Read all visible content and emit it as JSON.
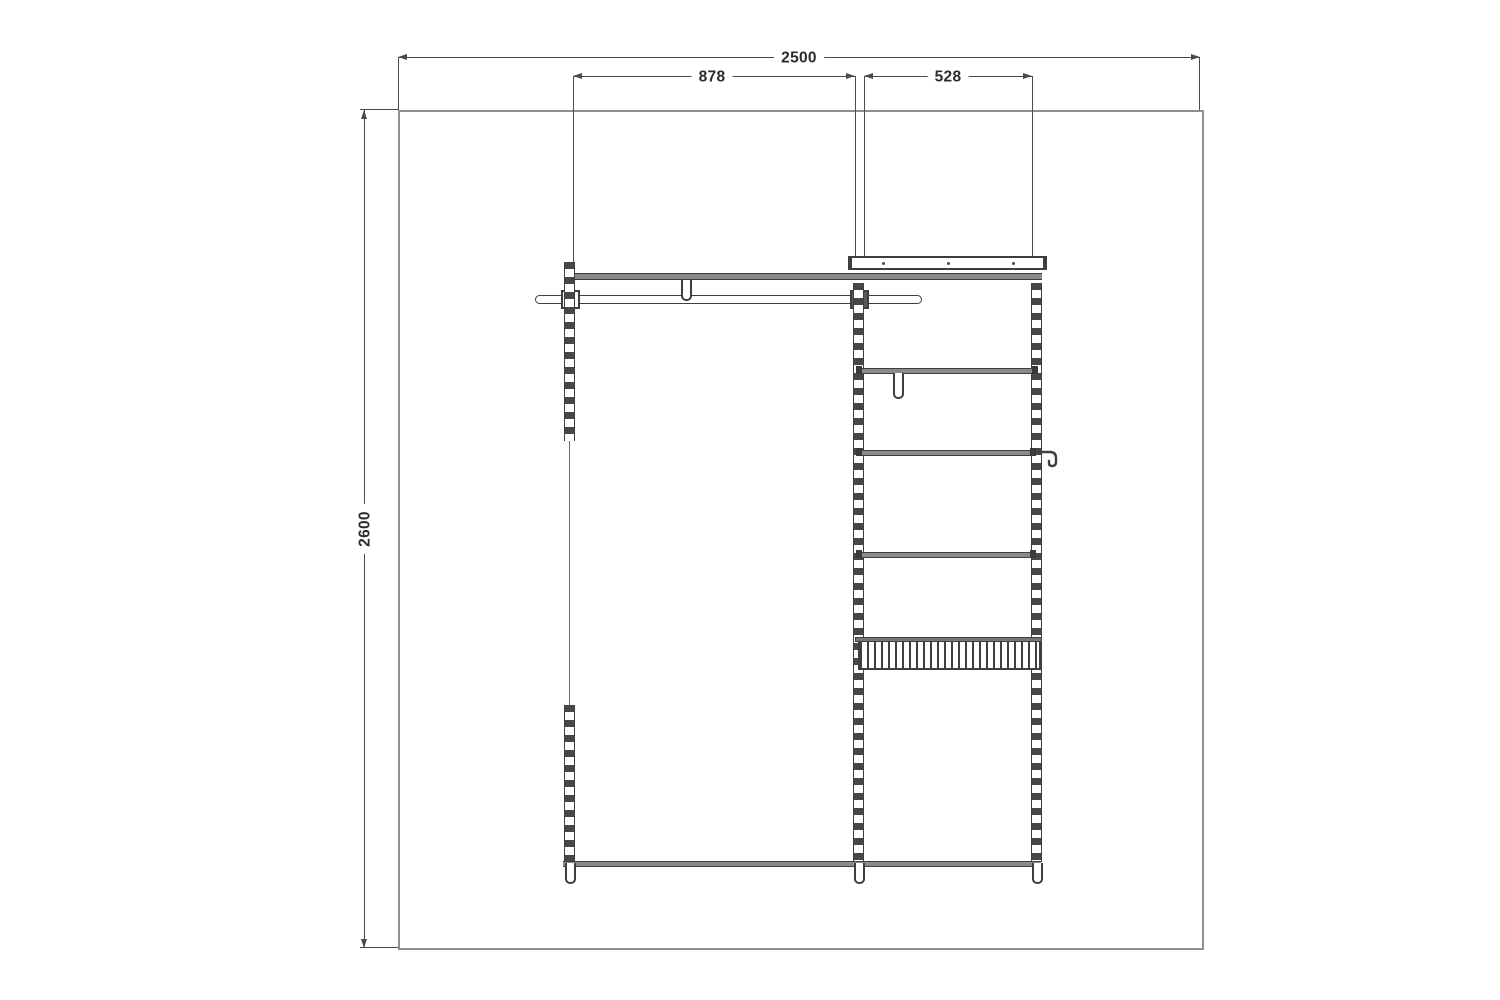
{
  "drawing": {
    "type": "closet-elevation-plan",
    "dimension_labels": {
      "overall_width": "2500",
      "left_bay_width": "878",
      "right_bay_width": "528",
      "overall_height": "2600"
    },
    "colors": {
      "line": "#3f3f3f",
      "dimension_line": "#4a4a4a",
      "wall_outline": "#8e8e8e",
      "shelf_fill": "#8a8a8a",
      "background": "#ffffff"
    },
    "components": [
      "wall-outline",
      "top-track",
      "top-shelf",
      "hanger-rod",
      "rod-support-bracket",
      "left-standard",
      "middle-standard",
      "right-standard",
      "shelf-1",
      "shelf-2",
      "shelf-3",
      "valet-hook",
      "side-hook",
      "wire-basket",
      "bottom-rail",
      "standard-feet"
    ]
  }
}
